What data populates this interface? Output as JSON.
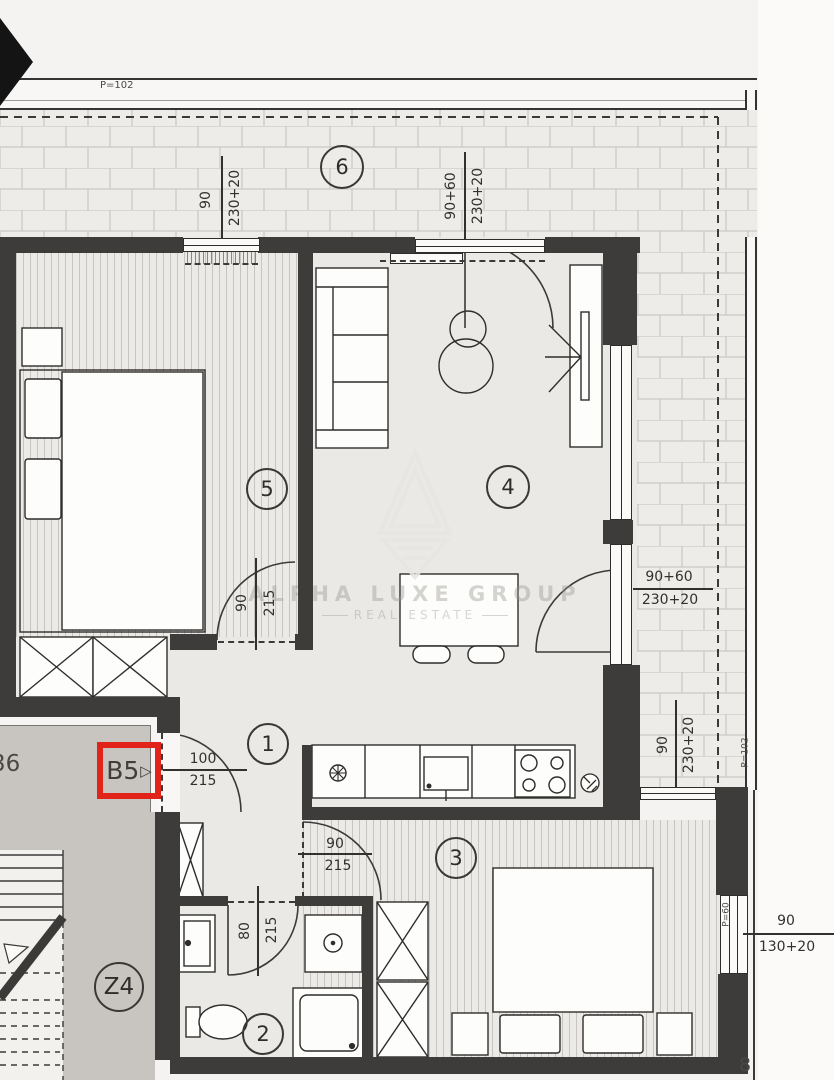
{
  "title": "Apartment B5 floor plan",
  "unit": {
    "label": "B5",
    "arrow": "▷"
  },
  "stairwell_label": "Z4",
  "partials": {
    "left": "36",
    "bottom_right": "8"
  },
  "room_numbers": {
    "r1": "1",
    "r2": "2",
    "r3": "3",
    "r4": "4",
    "r5": "5",
    "r6": "6"
  },
  "watermark": {
    "line1": "ALPHA LUXE GROUP",
    "line2": "REAL ESTATE"
  },
  "dims": {
    "rail_top": "P=102",
    "rail_right": "P=102",
    "win5_w": "90",
    "win5_h": "230+20",
    "terrace_door_w": "90+60",
    "terrace_door_h": "230+20",
    "slide_w": "90+60",
    "slide_h": "230+20",
    "terr_right_w": "90",
    "terr_right_h": "230+20",
    "door5_w": "90",
    "door5_h": "215",
    "entry_w": "100",
    "entry_h": "215",
    "door3_w": "90",
    "door3_h": "215",
    "bath_w": "80",
    "bath_h": "215",
    "win3_w": "90",
    "win3_h": "130+20",
    "win3_parapet": "P=60"
  },
  "colors": {
    "wall": "#3e3c3a",
    "accent_red": "#e2231a",
    "floor": "#eae9e6",
    "stair_floor": "#c8c5c0",
    "brick": "#edece9"
  }
}
